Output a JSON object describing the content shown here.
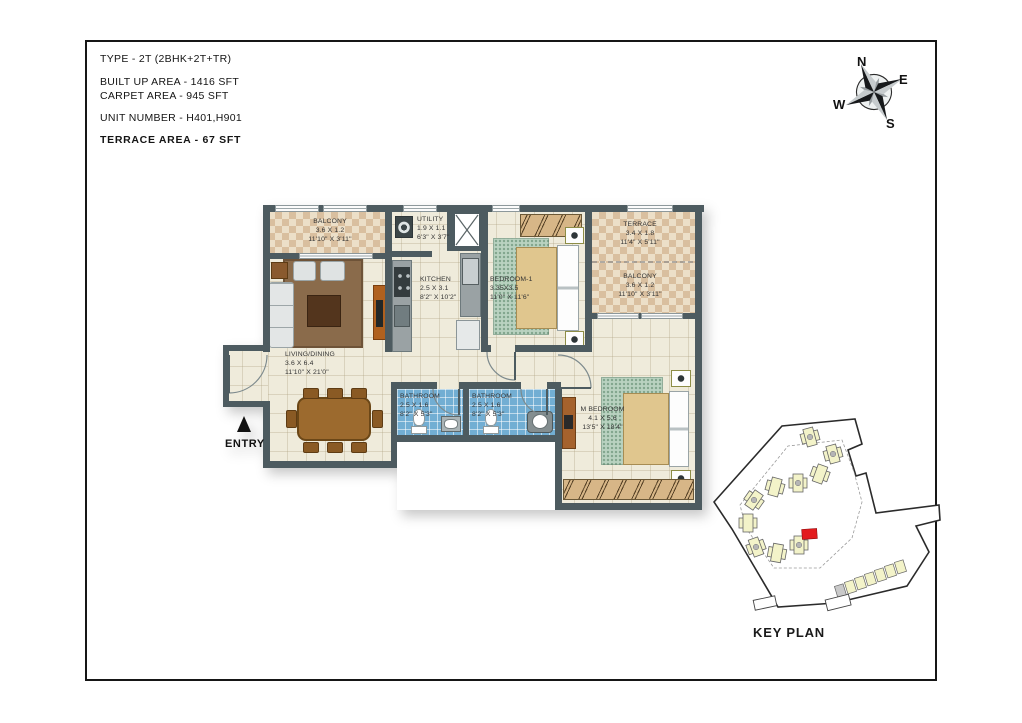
{
  "title_block": {
    "type": "TYPE - 2T (2BHK+2T+TR)",
    "built_up_area": "BUILT UP AREA - 1416 SFT",
    "carpet_area": "CARPET AREA - 945 SFT",
    "unit_number": "UNIT NUMBER - H401,H901",
    "terrace_area": "TERRACE AREA - 67 SFT"
  },
  "compass": {
    "north": "N",
    "east": "E",
    "south": "S",
    "west": "W"
  },
  "plan": {
    "entry_label": "ENTRY",
    "rooms": {
      "balcony_top_left": {
        "name": "BALCONY",
        "dim_m": "3.6 X 1.2",
        "dim_ft": "11'10\" X 3'11\""
      },
      "utility": {
        "name": "UTILITY",
        "dim_m": "1.9 X 1.1",
        "dim_ft": "6'3\" X 3'7\""
      },
      "kitchen": {
        "name": "KITCHEN",
        "dim_m": "2.5 X 3.1",
        "dim_ft": "8'2\" X 10'2\""
      },
      "bedroom_1": {
        "name": "BEDROOM-1",
        "dim_m": "3.35X3.5",
        "dim_ft": "11'0\" X 11'6\""
      },
      "terrace": {
        "name": "TERRACE",
        "dim_m": "3.4 X 1.8",
        "dim_ft": "11'4\" X 5'11\""
      },
      "balcony_right": {
        "name": "BALCONY",
        "dim_m": "3.6 X 1.2",
        "dim_ft": "11'10\" X 3'11\""
      },
      "living_dining": {
        "name": "LIVING/DINING",
        "dim_m": "3.6 X 6.4",
        "dim_ft": "11'10\" X 21'0\""
      },
      "bathroom_1": {
        "name": "BATHROOM",
        "dim_m": "2.5 X 1.6",
        "dim_ft": "8'2\" X 5'3\""
      },
      "bathroom_2": {
        "name": "BATHROOM",
        "dim_m": "2.5 X 1.6",
        "dim_ft": "8'2\" X 5'3\""
      },
      "master_bedroom": {
        "name": "M BEDROOM",
        "dim_m": "4.1 X 5.6",
        "dim_ft": "13'5\" X 18'4\""
      }
    }
  },
  "key_plan": {
    "label": "KEY PLAN"
  },
  "colors": {
    "wall": "#4d5b60",
    "floor": "#efebdb",
    "balcony_tile": "#d9bf9f",
    "bathroom_tile": "#72aed3",
    "rug_green": "#b9d2c0",
    "rug_brown": "#8a6b4b",
    "wood": "#9c6a2e",
    "keyplan_building": "#f3f3c9",
    "keyplan_highlight": "#e31b1d"
  }
}
